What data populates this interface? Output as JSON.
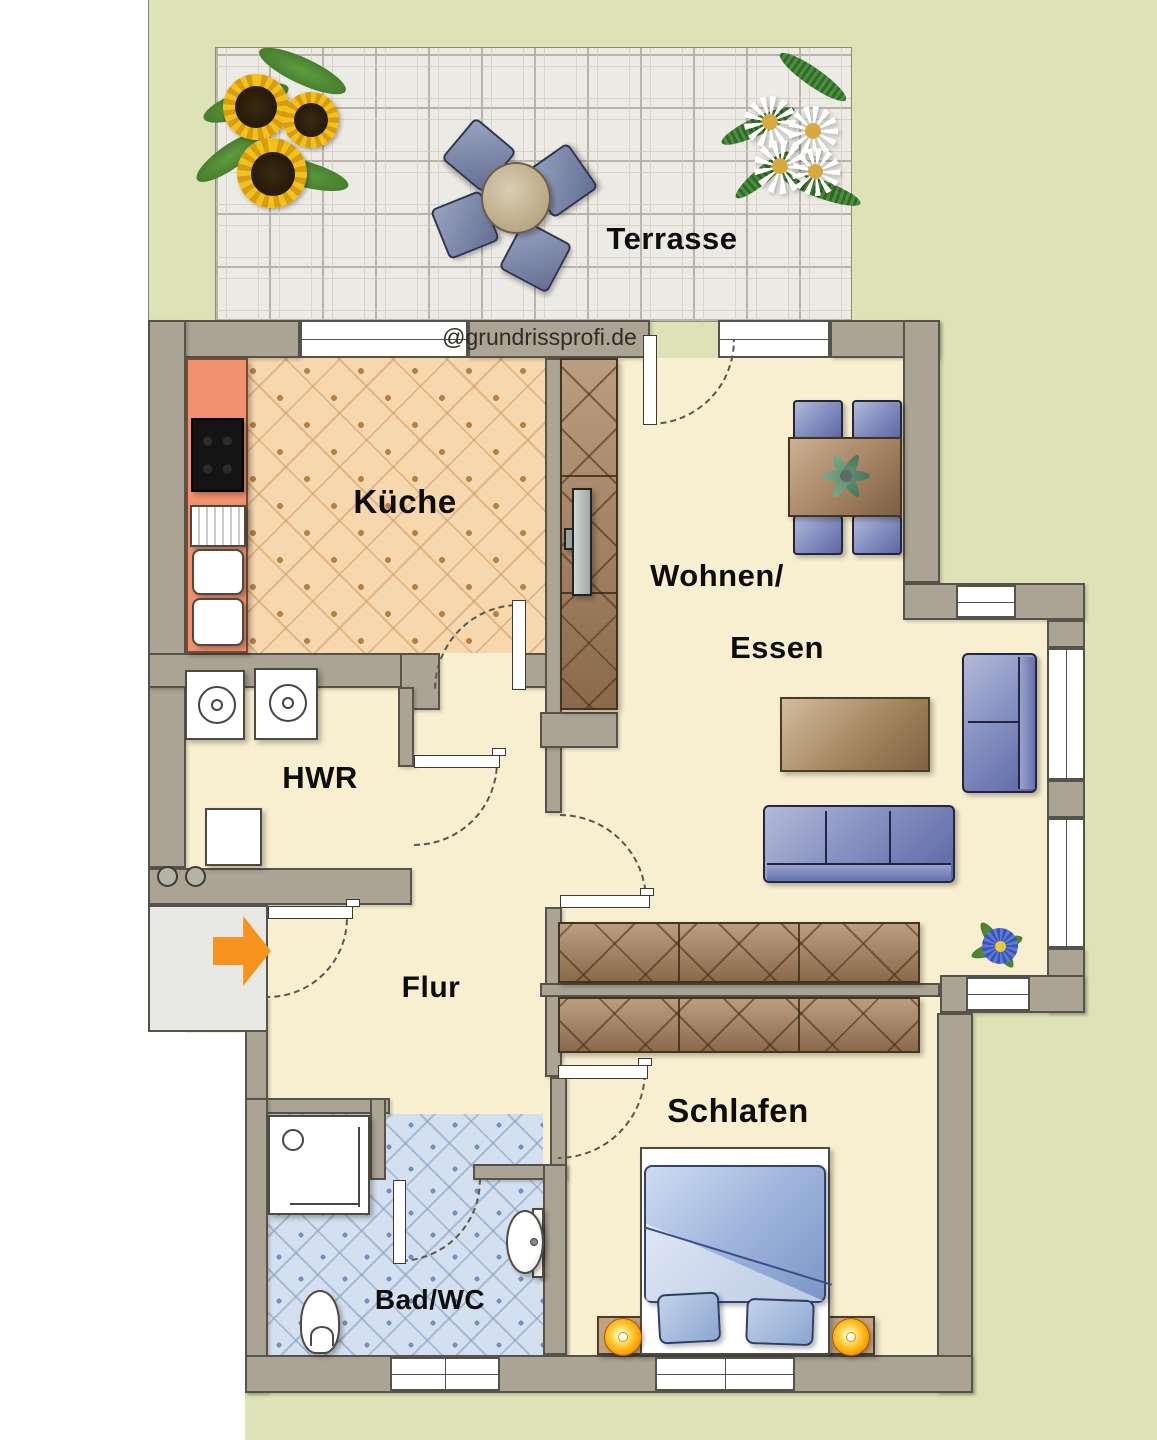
{
  "watermark": {
    "text": "@grundrissprofi.de"
  },
  "rooms": {
    "terrasse": {
      "label": "Terrasse"
    },
    "kueche": {
      "label": "Küche"
    },
    "wohnen_essen": {
      "label_line1": "Wohnen/",
      "label_line2": "Essen"
    },
    "hwr": {
      "label": "HWR"
    },
    "flur": {
      "label": "Flur"
    },
    "bad": {
      "label": "Bad/WC"
    },
    "schlafen": {
      "label": "Schlafen"
    }
  },
  "colors": {
    "background_green": "#dde3b6",
    "wall": "#aba495",
    "wall_outline": "#56534a",
    "floor_cream": "#f8efd0",
    "kitchen_floor": "#f7d7ae",
    "bath_floor": "#d4e0ef",
    "terrace_tile": "#eceae4",
    "kitchen_counter": "#f0926f",
    "furniture_blue": "#7b85b8",
    "furniture_brown": "#a98667",
    "lamp_orange": "#ffb214",
    "entrance_arrow_orange": "#f6921e"
  },
  "furniture_icons": [
    "terrace-table",
    "terrace-chair",
    "sunflowers",
    "daisies",
    "kitchen-counter",
    "cooktop",
    "sink-drainer",
    "sink-bowl",
    "tall-cupboard",
    "tv",
    "dining-table",
    "dining-chair",
    "table-plant",
    "coffee-table",
    "sofa",
    "loveseat",
    "flower-plant",
    "sideboard",
    "washing-machine",
    "dryer",
    "cabinet",
    "entrance-arrow",
    "shower",
    "toilet",
    "washbasin",
    "double-bed",
    "pillow",
    "nightstand",
    "bed-lamp"
  ]
}
